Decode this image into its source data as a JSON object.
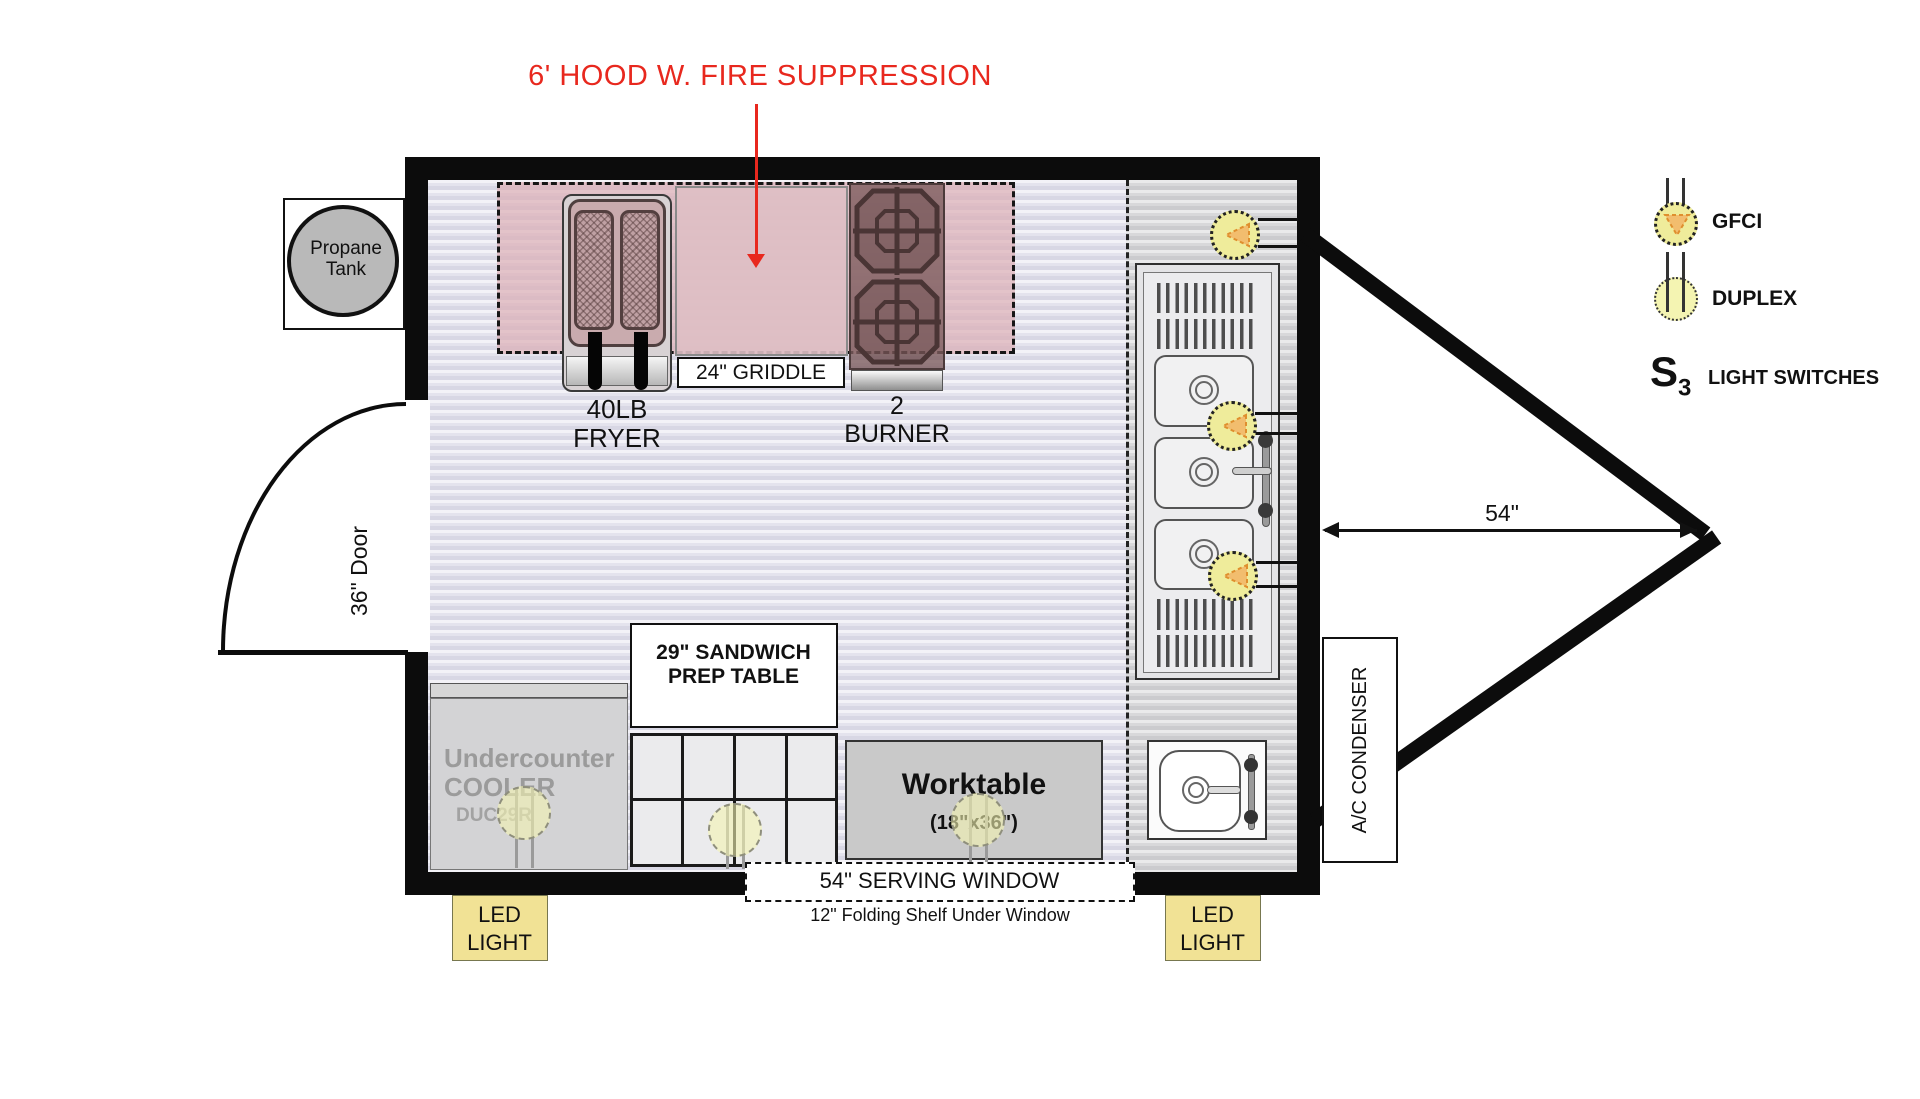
{
  "title": {
    "text": "6' HOOD W. FIRE SUPPRESSION"
  },
  "propane": {
    "line1": "Propane",
    "line2": "Tank"
  },
  "door": {
    "label": "36\" Door"
  },
  "equipment": {
    "fryer": {
      "line1": "40LB",
      "line2": "FRYER"
    },
    "griddle": {
      "label": "24\" GRIDDLE"
    },
    "burner": {
      "line1": "2",
      "line2": "BURNER"
    },
    "prep_table": {
      "line1": "29\" SANDWICH",
      "line2": "PREP TABLE"
    },
    "cooler": {
      "line1": "Undercounter",
      "line2": "COOLER",
      "model": "DUC29R"
    },
    "worktable": {
      "line1": "Worktable",
      "line2": "(18\"x36\")"
    }
  },
  "window": {
    "label": "54\" SERVING WINDOW",
    "sub": "12\" Folding Shelf Under Window"
  },
  "lights": {
    "led": {
      "line1": "LED",
      "line2": "LIGHT"
    }
  },
  "ac": {
    "label": "A/C CONDENSER"
  },
  "dimension": {
    "label": "54\""
  },
  "legend": {
    "gfci": "GFCI",
    "duplex": "DUPLEX",
    "switch_symbol": "S",
    "switch_sub": "3",
    "switches": "LIGHT SWITCHES"
  },
  "colors": {
    "accent_red": "#e8281e",
    "hood_pink": "#ddb0b7",
    "symbol_yellow": "#efec9b",
    "led_yellow": "#f1e295",
    "wall_black": "#0c0c0c",
    "floor_lavender": "#e4e3ed"
  }
}
